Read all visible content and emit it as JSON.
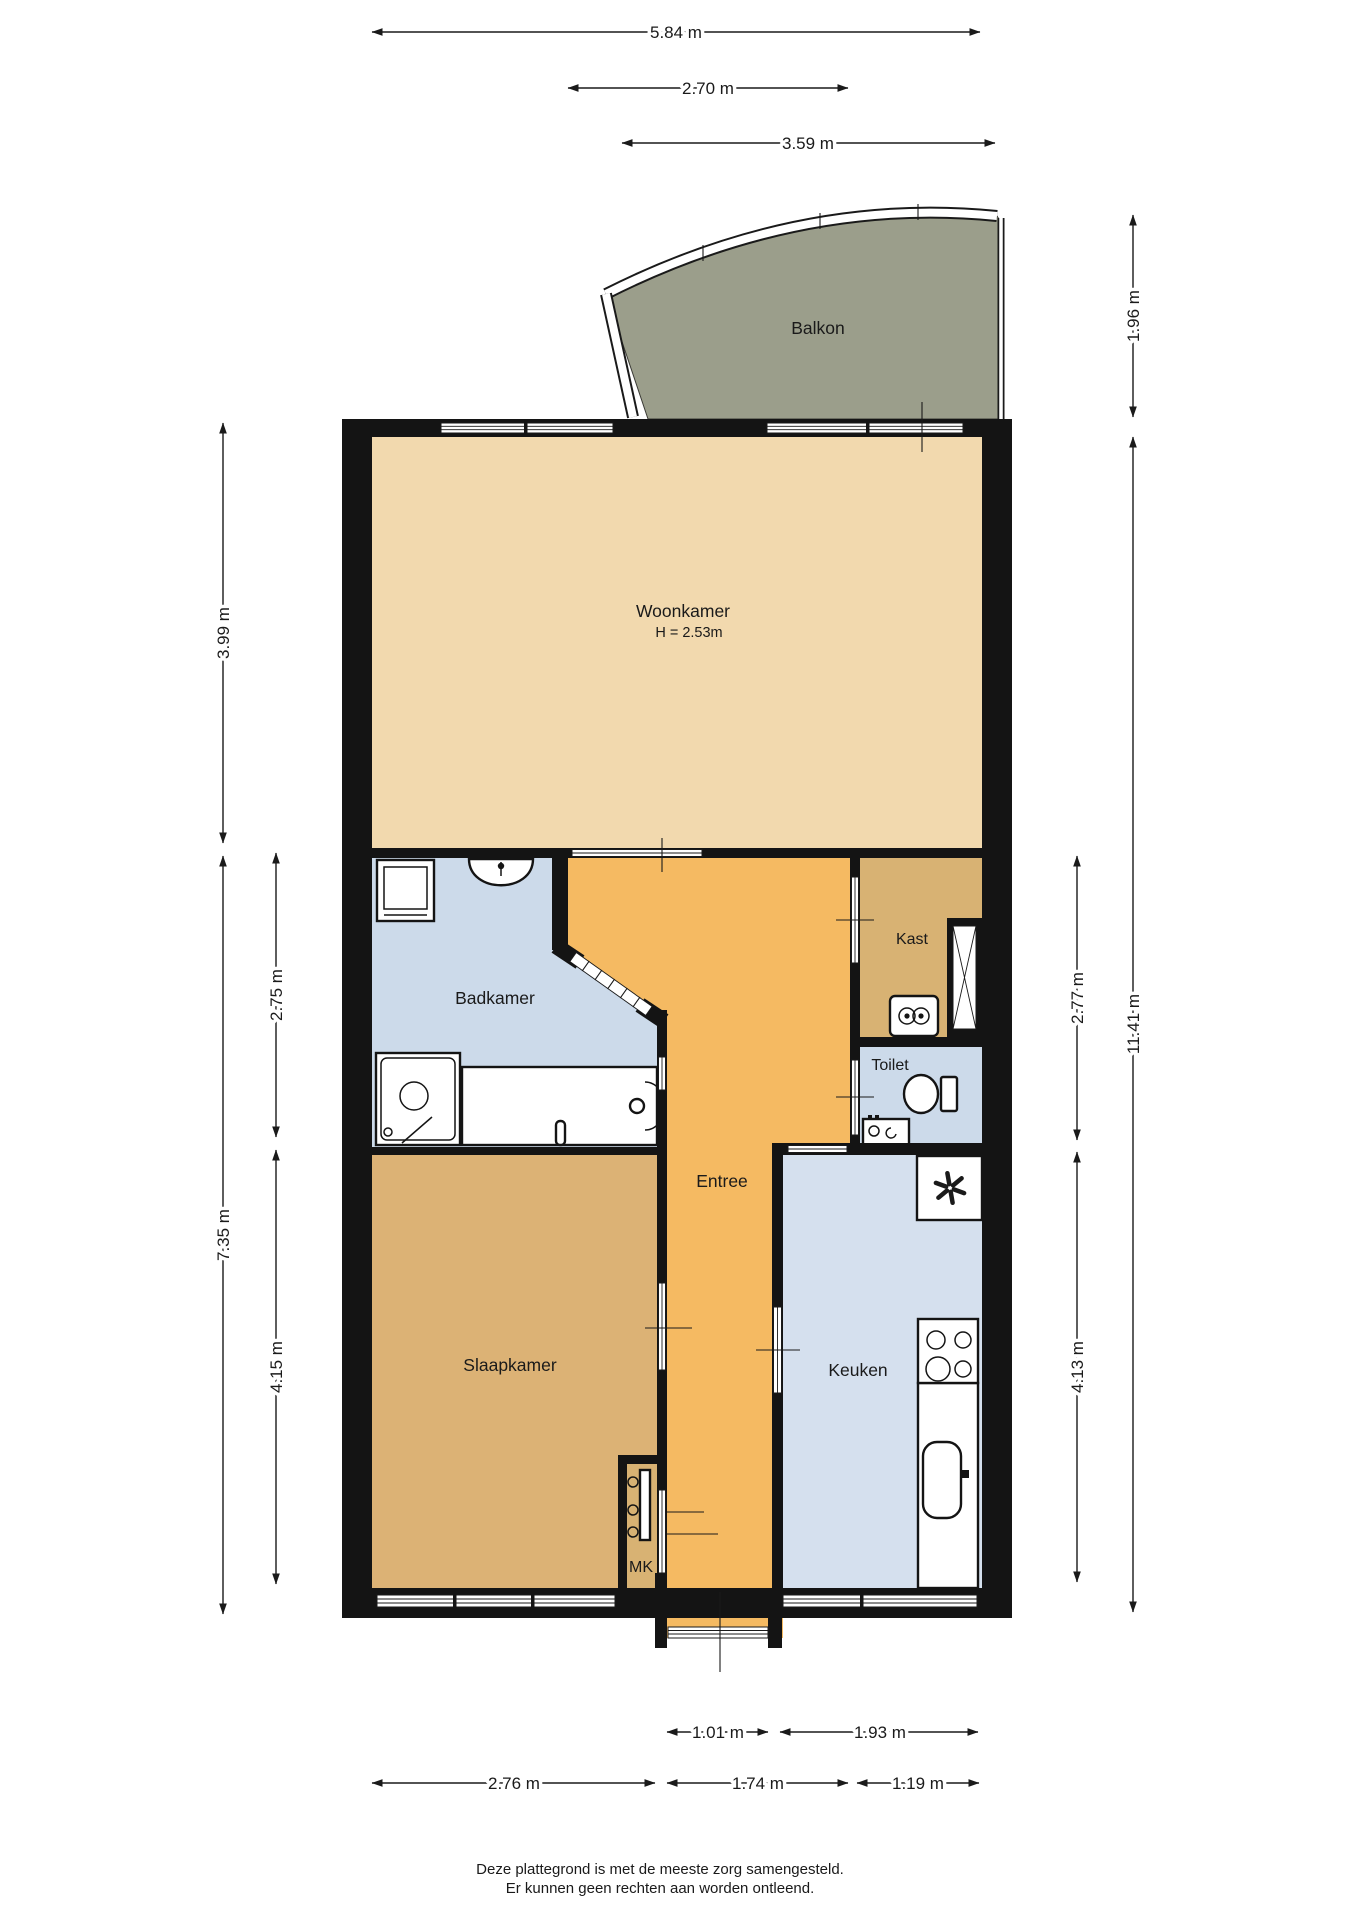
{
  "rooms": {
    "balkon": "Balkon",
    "woonkamer": "Woonkamer",
    "woonkamer_height": "H = 2.53m",
    "badkamer": "Badkamer",
    "kast": "Kast",
    "toilet": "Toilet",
    "entree": "Entree",
    "slaapkamer": "Slaapkamer",
    "keuken": "Keuken",
    "mk": "MK"
  },
  "dimensions": {
    "top": [
      "5.84 m",
      "2.70 m",
      "3.59 m"
    ],
    "left": [
      "3.99 m",
      "7.35 m",
      "2.75 m",
      "4.15 m"
    ],
    "right": [
      "1.96 m",
      "11.41 m",
      "2.77 m",
      "4.13 m"
    ],
    "bottom": [
      "1.01 m",
      "1.93 m",
      "2.76 m",
      "1.74 m",
      "1.19 m"
    ]
  },
  "colors": {
    "wall": "#141414",
    "woonkamer": "#f2d9ae",
    "entree": "#f5ba62",
    "slaapkamer": "#dcb275",
    "kast": "#d8b273",
    "badkamer": "#ccdaea",
    "toilet": "#ccdaea",
    "keuken": "#d5e0ee",
    "balkon": "#9b9e8b"
  },
  "footer": {
    "line1": "Deze plattegrond is met de meeste zorg samengesteld.",
    "line2": "Er kunnen geen rechten aan worden ontleend."
  }
}
